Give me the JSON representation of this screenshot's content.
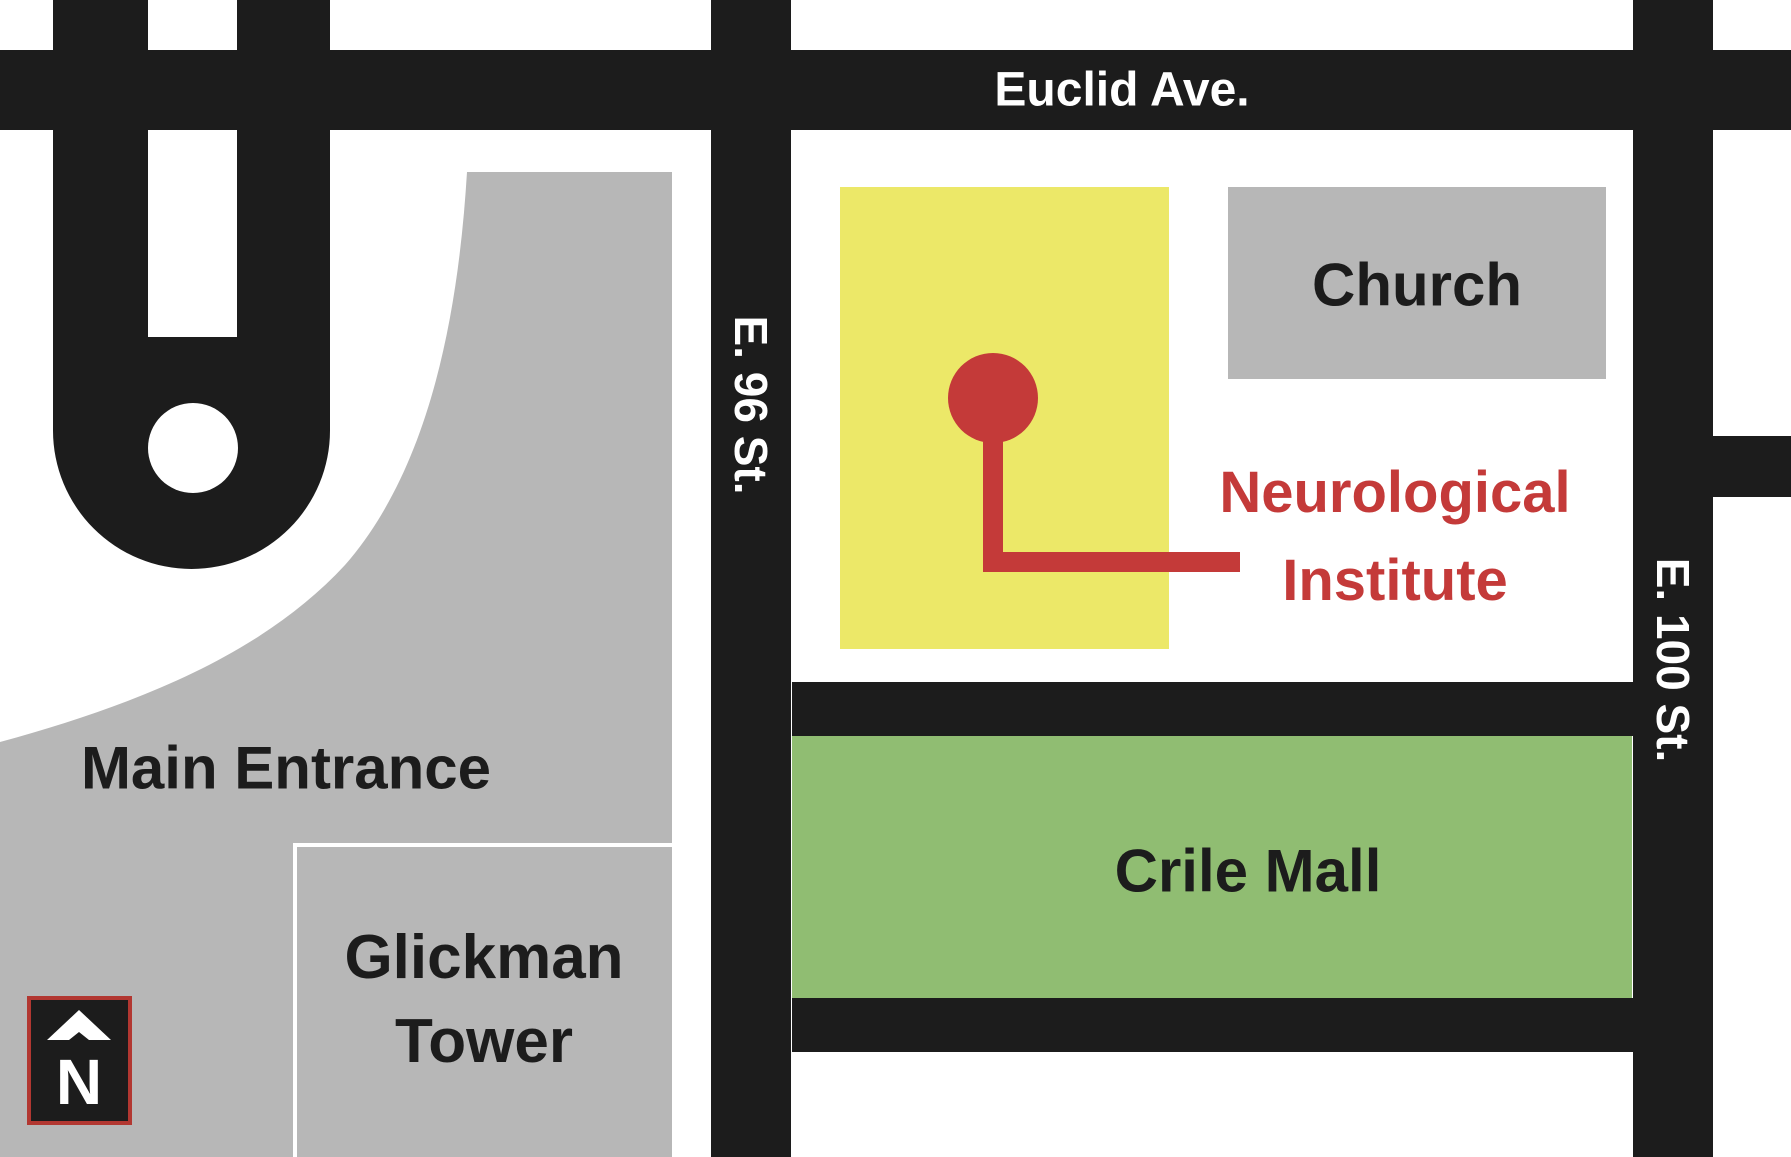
{
  "labels": {
    "euclid_ave": "Euclid Ave.",
    "e96_st": "E. 96 St.",
    "e100_st": "E. 100 St.",
    "church": "Church",
    "main_entrance": "Main Entrance",
    "glickman_line1": "Glickman",
    "glickman_line2": "Tower",
    "crile_mall": "Crile Mall",
    "neuro_line1": "Neurological",
    "neuro_line2": "Institute",
    "north_indicator": "N"
  },
  "colors": {
    "road_black": "#1c1c1c",
    "building_gray": "#b7b7b7",
    "highlight_yellow": "#ece868",
    "mall_green": "#90bd72",
    "accent_red": "#c43a39",
    "north_box_border": "#b23731",
    "road_label_text": "#ffffff"
  }
}
